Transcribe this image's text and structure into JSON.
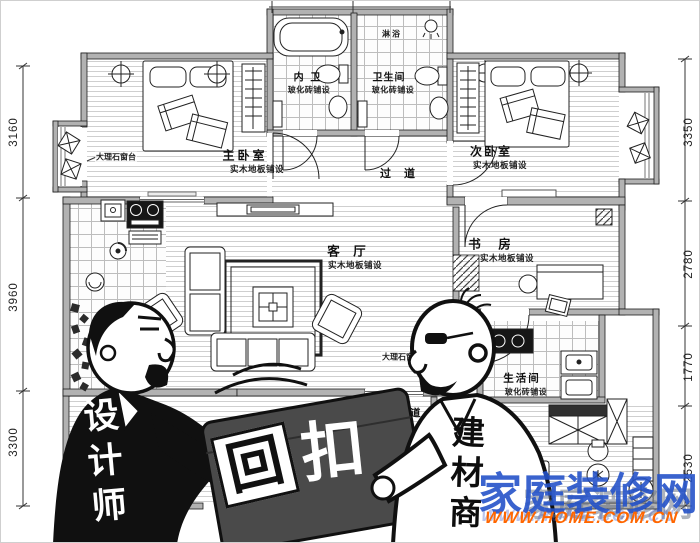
{
  "plan": {
    "rooms": {
      "master": {
        "name": "主卧室",
        "floor": "实木地板铺设"
      },
      "second": {
        "name": "次卧室",
        "floor": "实木地板铺设"
      },
      "inner_bath": {
        "name": "内 卫",
        "floor": "玻化砖铺设"
      },
      "bath": {
        "name": "卫生间",
        "floor": "玻化砖铺设"
      },
      "shower": {
        "name": "淋浴"
      },
      "hall_upper": {
        "name": "过 道"
      },
      "living": {
        "name": "客 厅",
        "floor": "实木地板铺设"
      },
      "study": {
        "name": "书 房",
        "floor": "实木地板铺设"
      },
      "utility": {
        "name": "生活间",
        "floor": "玻化砖铺设"
      },
      "hall_lower": {
        "name": "过 道"
      }
    },
    "annotations": {
      "marble_sill": "大理石窗台",
      "marble_window": "大理石窗"
    },
    "dimensions": {
      "left": [
        "3160",
        "3960",
        "3300"
      ],
      "right": [
        "3350",
        "2780",
        "1770",
        "2530"
      ]
    },
    "wall_color": "#b2b2b2"
  },
  "cartoon": {
    "designer": "设计师",
    "merchant": "建材商",
    "kickback": [
      "回",
      "扣"
    ]
  },
  "watermark": {
    "site": "家庭装修网",
    "site_echo": "家庭装修网",
    "url": "WWW.HOME.COM.CN",
    "blue": "#2553c9",
    "orange": "#ff6600"
  }
}
